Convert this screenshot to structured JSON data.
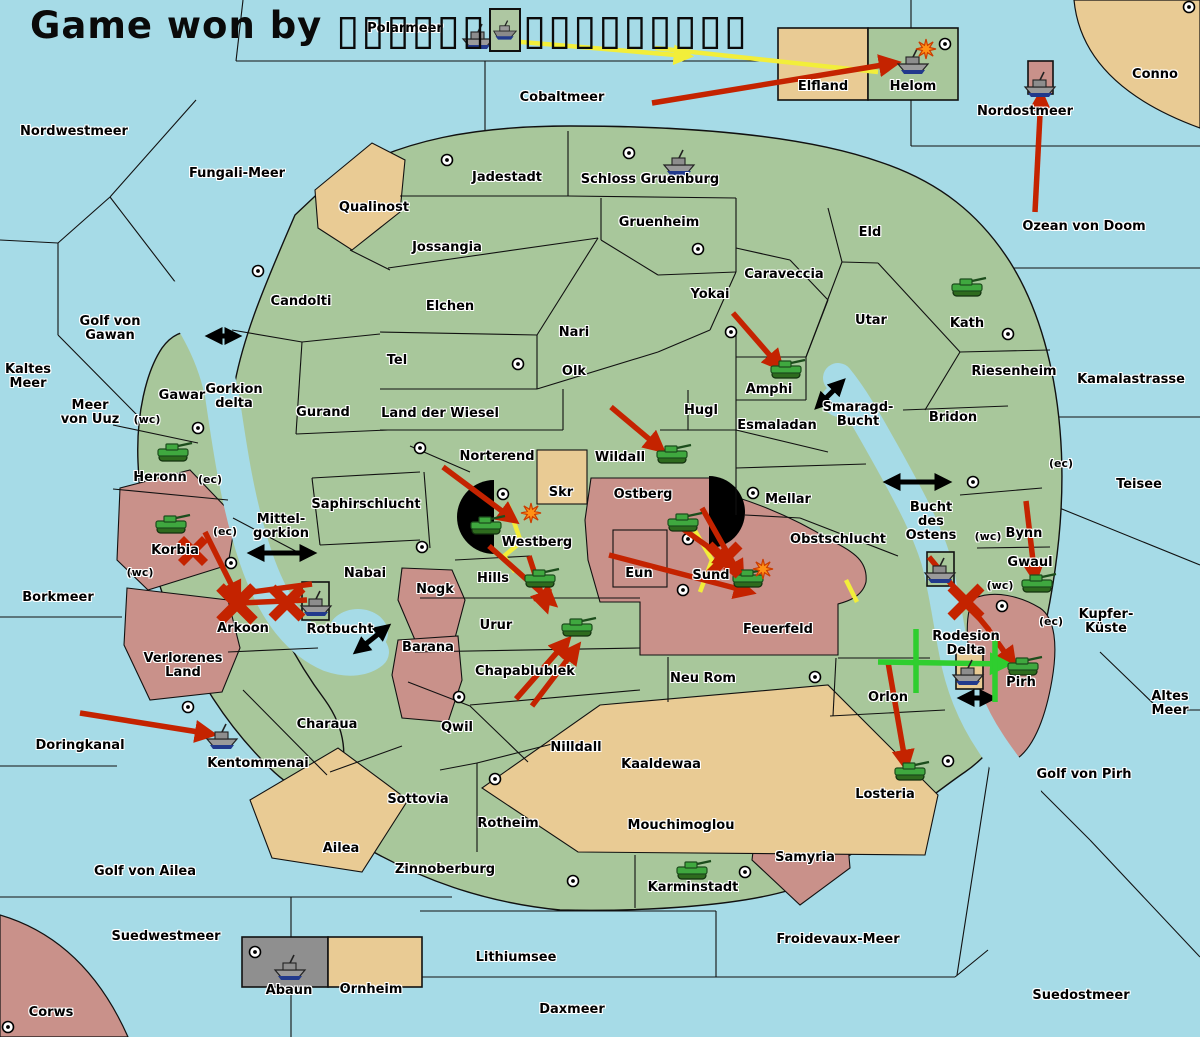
{
  "title": {
    "prefix": "Game won by",
    "tofu_left": "▯▯▯▯▯▯",
    "tofu_right": "▯▯▯▯▯▯▯▯▯"
  },
  "colors": {
    "sea": "#a6dbe7",
    "land": "#a8c79b",
    "tan": "#e9cb94",
    "rose": "#c9918a",
    "gray": "#8f8f8f",
    "border": "#111111",
    "red": "#c42300",
    "yellow": "#f2ee3a",
    "green": "#2fce2f",
    "black": "#000000",
    "explosion": "#ff9015"
  },
  "sea_labels": [
    {
      "text": "Polarmeer",
      "x": 405,
      "y": 29
    },
    {
      "text": "Cobaltmeer",
      "x": 562,
      "y": 98
    },
    {
      "text": "Nordwestmeer",
      "x": 74,
      "y": 132
    },
    {
      "text": "Fungali-Meer",
      "x": 237,
      "y": 174
    },
    {
      "text": "Golf von\nGawan",
      "x": 110,
      "y": 329
    },
    {
      "text": "Kaltes\nMeer",
      "x": 28,
      "y": 377
    },
    {
      "text": "Meer\nvon Uuz",
      "x": 90,
      "y": 413
    },
    {
      "text": "Gorkion\ndelta",
      "x": 234,
      "y": 397
    },
    {
      "text": "Mittel-\ngorkion",
      "x": 281,
      "y": 527
    },
    {
      "text": "Borkmeer",
      "x": 58,
      "y": 598
    },
    {
      "text": "Rotbucht",
      "x": 340,
      "y": 630
    },
    {
      "text": "Doringkanal",
      "x": 80,
      "y": 746
    },
    {
      "text": "Golf von Ailea",
      "x": 145,
      "y": 872
    },
    {
      "text": "Suedwestmeer",
      "x": 166,
      "y": 937
    },
    {
      "text": "Lithiumsee",
      "x": 516,
      "y": 958
    },
    {
      "text": "Daxmeer",
      "x": 572,
      "y": 1010
    },
    {
      "text": "Froidevaux-Meer",
      "x": 838,
      "y": 940
    },
    {
      "text": "Suedostmeer",
      "x": 1081,
      "y": 996
    },
    {
      "text": "Golf von Pirh",
      "x": 1084,
      "y": 775
    },
    {
      "text": "Altes\nMeer",
      "x": 1170,
      "y": 704
    },
    {
      "text": "Kupfer-\nKüste",
      "x": 1106,
      "y": 622
    },
    {
      "text": "Teisee",
      "x": 1139,
      "y": 485
    },
    {
      "text": "Kamalastrasse",
      "x": 1131,
      "y": 380
    },
    {
      "text": "Ozean von Doom",
      "x": 1084,
      "y": 227
    },
    {
      "text": "Nordostmeer",
      "x": 1025,
      "y": 112
    },
    {
      "text": "Smaragd-\nBucht",
      "x": 858,
      "y": 415
    },
    {
      "text": "Bucht\ndes\nOstens",
      "x": 931,
      "y": 522
    }
  ],
  "land_labels": [
    {
      "text": "Conno",
      "x": 1155,
      "y": 75
    },
    {
      "text": "Elfland",
      "x": 823,
      "y": 87
    },
    {
      "text": "Helom",
      "x": 913,
      "y": 87
    },
    {
      "text": "Jadestadt",
      "x": 507,
      "y": 178
    },
    {
      "text": "Schloss Gruenburg",
      "x": 650,
      "y": 180
    },
    {
      "text": "Qualinost",
      "x": 374,
      "y": 208
    },
    {
      "text": "Gruenheim",
      "x": 659,
      "y": 223
    },
    {
      "text": "Eld",
      "x": 870,
      "y": 233
    },
    {
      "text": "Jossangia",
      "x": 447,
      "y": 248
    },
    {
      "text": "Caraveccia",
      "x": 784,
      "y": 275
    },
    {
      "text": "Yokai",
      "x": 710,
      "y": 295
    },
    {
      "text": "Candolti",
      "x": 301,
      "y": 302
    },
    {
      "text": "Elchen",
      "x": 450,
      "y": 307
    },
    {
      "text": "Utar",
      "x": 871,
      "y": 321
    },
    {
      "text": "Kath",
      "x": 967,
      "y": 324
    },
    {
      "text": "Nari",
      "x": 574,
      "y": 333
    },
    {
      "text": "Tel",
      "x": 397,
      "y": 361
    },
    {
      "text": "Olk",
      "x": 574,
      "y": 372
    },
    {
      "text": "Riesenheim",
      "x": 1014,
      "y": 372
    },
    {
      "text": "Amphi",
      "x": 769,
      "y": 390
    },
    {
      "text": "Gawar",
      "x": 182,
      "y": 396
    },
    {
      "text": "Gurand",
      "x": 323,
      "y": 413
    },
    {
      "text": "Land der Wiesel",
      "x": 440,
      "y": 414
    },
    {
      "text": "Hugl",
      "x": 701,
      "y": 411
    },
    {
      "text": "Bridon",
      "x": 953,
      "y": 418
    },
    {
      "text": "Esmaladan",
      "x": 777,
      "y": 426
    },
    {
      "text": "Norterend",
      "x": 497,
      "y": 457
    },
    {
      "text": "Wildall",
      "x": 620,
      "y": 458
    },
    {
      "text": "Heronn",
      "x": 160,
      "y": 478
    },
    {
      "text": "Skr",
      "x": 561,
      "y": 493
    },
    {
      "text": "Ostberg",
      "x": 643,
      "y": 495
    },
    {
      "text": "Mellar",
      "x": 788,
      "y": 500
    },
    {
      "text": "Saphirschlucht",
      "x": 366,
      "y": 505
    },
    {
      "text": "Obstschlucht",
      "x": 838,
      "y": 540
    },
    {
      "text": "Westberg",
      "x": 537,
      "y": 543
    },
    {
      "text": "Korbia",
      "x": 175,
      "y": 551
    },
    {
      "text": "Bynn",
      "x": 1024,
      "y": 534
    },
    {
      "text": "Gwaul",
      "x": 1030,
      "y": 563
    },
    {
      "text": "Nabai",
      "x": 365,
      "y": 574
    },
    {
      "text": "Eun",
      "x": 639,
      "y": 574
    },
    {
      "text": "Sund",
      "x": 711,
      "y": 576
    },
    {
      "text": "Hills",
      "x": 493,
      "y": 579
    },
    {
      "text": "Nogk",
      "x": 435,
      "y": 590
    },
    {
      "text": "Urur",
      "x": 496,
      "y": 626
    },
    {
      "text": "Arkoon",
      "x": 243,
      "y": 629
    },
    {
      "text": "Feuerfeld",
      "x": 778,
      "y": 630
    },
    {
      "text": "Rodesion\nDelta",
      "x": 966,
      "y": 644
    },
    {
      "text": "Barana",
      "x": 428,
      "y": 648
    },
    {
      "text": "Verlorenes\nLand",
      "x": 183,
      "y": 666
    },
    {
      "text": "Chapablublek",
      "x": 525,
      "y": 672
    },
    {
      "text": "Neu Rom",
      "x": 703,
      "y": 679
    },
    {
      "text": "Pirh",
      "x": 1021,
      "y": 683
    },
    {
      "text": "Orlon",
      "x": 888,
      "y": 698
    },
    {
      "text": "Charaua",
      "x": 327,
      "y": 725
    },
    {
      "text": "Qwil",
      "x": 457,
      "y": 728
    },
    {
      "text": "Nilldall",
      "x": 576,
      "y": 748
    },
    {
      "text": "Kentommenai",
      "x": 258,
      "y": 764
    },
    {
      "text": "Kaaldewaa",
      "x": 661,
      "y": 765
    },
    {
      "text": "Losteria",
      "x": 885,
      "y": 795
    },
    {
      "text": "Sottovia",
      "x": 418,
      "y": 800
    },
    {
      "text": "Rotheim",
      "x": 508,
      "y": 824
    },
    {
      "text": "Mouchimoglou",
      "x": 681,
      "y": 826
    },
    {
      "text": "Ailea",
      "x": 341,
      "y": 849
    },
    {
      "text": "Samyria",
      "x": 805,
      "y": 858
    },
    {
      "text": "Zinnoberburg",
      "x": 445,
      "y": 870
    },
    {
      "text": "Karminstadt",
      "x": 693,
      "y": 888
    },
    {
      "text": "Abaun",
      "x": 289,
      "y": 991
    },
    {
      "text": "Ornheim",
      "x": 371,
      "y": 990
    },
    {
      "text": "Corws",
      "x": 51,
      "y": 1013
    }
  ],
  "coast_tags": [
    {
      "text": "(wc)",
      "x": 147,
      "y": 420
    },
    {
      "text": "(ec)",
      "x": 210,
      "y": 480
    },
    {
      "text": "(ec)",
      "x": 225,
      "y": 532
    },
    {
      "text": "(wc)",
      "x": 140,
      "y": 573
    },
    {
      "text": "(ec)",
      "x": 1061,
      "y": 464
    },
    {
      "text": "(wc)",
      "x": 988,
      "y": 537
    },
    {
      "text": "(wc)",
      "x": 1000,
      "y": 586
    },
    {
      "text": "(ec)",
      "x": 1051,
      "y": 622
    }
  ],
  "supply_centers": [
    [
      447,
      160
    ],
    [
      629,
      153
    ],
    [
      698,
      249
    ],
    [
      258,
      271
    ],
    [
      518,
      364
    ],
    [
      731,
      332
    ],
    [
      945,
      44
    ],
    [
      1189,
      7
    ],
    [
      1008,
      334
    ],
    [
      973,
      482
    ],
    [
      198,
      428
    ],
    [
      231,
      563
    ],
    [
      420,
      448
    ],
    [
      422,
      547
    ],
    [
      503,
      494
    ],
    [
      688,
      539
    ],
    [
      683,
      590
    ],
    [
      753,
      493
    ],
    [
      188,
      707
    ],
    [
      459,
      697
    ],
    [
      495,
      779
    ],
    [
      573,
      881
    ],
    [
      745,
      872
    ],
    [
      815,
      677
    ],
    [
      948,
      761
    ],
    [
      1002,
      606
    ],
    [
      255,
      952
    ],
    [
      8,
      1027
    ]
  ],
  "units": [
    {
      "type": "ship",
      "x": 478,
      "y": 37
    },
    {
      "type": "ship",
      "x": 913,
      "y": 62
    },
    {
      "type": "ship",
      "x": 679,
      "y": 163
    },
    {
      "type": "ship",
      "x": 1040,
      "y": 85
    },
    {
      "type": "ship",
      "x": 316,
      "y": 604
    },
    {
      "type": "ship",
      "x": 222,
      "y": 737
    },
    {
      "type": "ship",
      "x": 290,
      "y": 968
    },
    {
      "type": "ship",
      "x": 940,
      "y": 571
    },
    {
      "type": "ship",
      "x": 968,
      "y": 673
    },
    {
      "type": "tank",
      "x": 173,
      "y": 454
    },
    {
      "type": "tank",
      "x": 171,
      "y": 526
    },
    {
      "type": "tank",
      "x": 967,
      "y": 289
    },
    {
      "type": "tank",
      "x": 786,
      "y": 371
    },
    {
      "type": "tank",
      "x": 672,
      "y": 456
    },
    {
      "type": "tank",
      "x": 486,
      "y": 527
    },
    {
      "type": "tank",
      "x": 540,
      "y": 580
    },
    {
      "type": "tank",
      "x": 683,
      "y": 524
    },
    {
      "type": "tank",
      "x": 748,
      "y": 580
    },
    {
      "type": "tank",
      "x": 577,
      "y": 629
    },
    {
      "type": "tank",
      "x": 692,
      "y": 872
    },
    {
      "type": "tank",
      "x": 1037,
      "y": 585
    },
    {
      "type": "tank",
      "x": 1023,
      "y": 668
    },
    {
      "type": "tank",
      "x": 910,
      "y": 773
    }
  ],
  "explosions": [
    [
      926,
      49
    ],
    [
      531,
      513
    ],
    [
      763,
      569
    ]
  ],
  "x_marks": [
    {
      "x": 193,
      "y": 551,
      "r": 12
    },
    {
      "x": 237,
      "y": 604,
      "r": 17
    },
    {
      "x": 287,
      "y": 603,
      "r": 15
    },
    {
      "x": 724,
      "y": 560,
      "r": 15
    },
    {
      "x": 966,
      "y": 602,
      "r": 15
    }
  ],
  "arrows_red": [
    {
      "x1": 652,
      "y1": 103,
      "x2": 895,
      "y2": 63,
      "head": true
    },
    {
      "x1": 1035,
      "y1": 212,
      "x2": 1041,
      "y2": 95,
      "head": true
    },
    {
      "x1": 733,
      "y1": 313,
      "x2": 780,
      "y2": 367,
      "head": true
    },
    {
      "x1": 611,
      "y1": 407,
      "x2": 661,
      "y2": 449,
      "head": true
    },
    {
      "x1": 443,
      "y1": 467,
      "x2": 514,
      "y2": 520,
      "head": true
    },
    {
      "x1": 489,
      "y1": 546,
      "x2": 553,
      "y2": 603,
      "head": true
    },
    {
      "x1": 529,
      "y1": 556,
      "x2": 546,
      "y2": 608,
      "head": true
    },
    {
      "x1": 609,
      "y1": 555,
      "x2": 750,
      "y2": 592,
      "head": true
    },
    {
      "x1": 676,
      "y1": 524,
      "x2": 731,
      "y2": 563,
      "head": true
    },
    {
      "x1": 702,
      "y1": 508,
      "x2": 741,
      "y2": 577,
      "head": true
    },
    {
      "x1": 205,
      "y1": 532,
      "x2": 238,
      "y2": 598,
      "head": true
    },
    {
      "x1": 80,
      "y1": 713,
      "x2": 211,
      "y2": 734,
      "head": true
    },
    {
      "x1": 516,
      "y1": 699,
      "x2": 567,
      "y2": 641,
      "head": true
    },
    {
      "x1": 532,
      "y1": 706,
      "x2": 577,
      "y2": 647,
      "head": true
    },
    {
      "x1": 1026,
      "y1": 501,
      "x2": 1035,
      "y2": 578,
      "head": true
    },
    {
      "x1": 888,
      "y1": 662,
      "x2": 906,
      "y2": 766,
      "head": true
    },
    {
      "x1": 988,
      "y1": 629,
      "x2": 1013,
      "y2": 664,
      "head": true
    },
    {
      "x1": 929,
      "y1": 557,
      "x2": 989,
      "y2": 630,
      "head": false
    },
    {
      "x1": 240,
      "y1": 603,
      "x2": 307,
      "y2": 600,
      "head": false
    },
    {
      "x1": 252,
      "y1": 592,
      "x2": 312,
      "y2": 584,
      "head": false
    }
  ],
  "arrows_yellow": [
    {
      "points": [
        [
          497,
          40
        ],
        [
          688,
          56
        ]
      ],
      "head": true
    },
    {
      "points": [
        [
          655,
          48
        ],
        [
          878,
          72
        ]
      ],
      "head": false
    },
    {
      "points": [
        [
          508,
          505
        ],
        [
          521,
          542
        ],
        [
          504,
          556
        ],
        [
          515,
          572
        ]
      ],
      "head": false
    },
    {
      "points": [
        [
          688,
          519
        ],
        [
          712,
          560
        ],
        [
          700,
          592
        ]
      ],
      "head": false
    },
    {
      "points": [
        [
          846,
          580
        ],
        [
          857,
          602
        ]
      ],
      "head": false
    }
  ],
  "arrows_green": [
    {
      "points": [
        [
          878,
          662
        ],
        [
          1006,
          664
        ]
      ],
      "head": true
    },
    {
      "points": [
        [
          916,
          629
        ],
        [
          916,
          693
        ]
      ],
      "head": false
    },
    {
      "points": [
        [
          995,
          639
        ],
        [
          995,
          702
        ]
      ],
      "head": false
    }
  ],
  "arrows_black_double": [
    {
      "x1": 210,
      "y1": 336,
      "x2": 237,
      "y2": 336
    },
    {
      "x1": 252,
      "y1": 553,
      "x2": 312,
      "y2": 553
    },
    {
      "x1": 357,
      "y1": 651,
      "x2": 387,
      "y2": 627
    },
    {
      "x1": 818,
      "y1": 406,
      "x2": 842,
      "y2": 382
    },
    {
      "x1": 888,
      "y1": 482,
      "x2": 947,
      "y2": 482
    },
    {
      "x1": 962,
      "y1": 698,
      "x2": 992,
      "y2": 698
    }
  ]
}
